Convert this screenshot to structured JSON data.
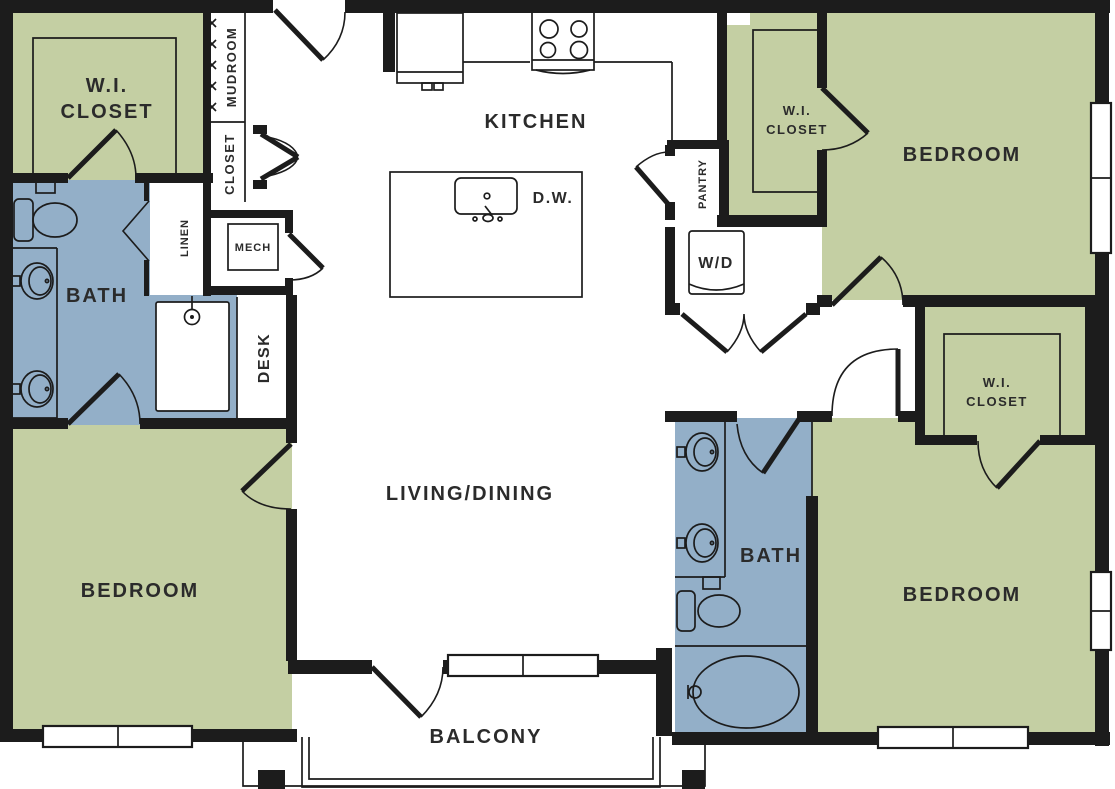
{
  "title": "Apartment floor plan",
  "colors": {
    "room_green": "#c4cfa3",
    "room_blue": "#93afc8",
    "wall": "#1c1c1c",
    "text": "#2b2b2b",
    "background": "#ffffff"
  },
  "rooms": [
    {
      "id": "wi-closet-top-left",
      "label_line1": "W.I.",
      "label_line2": "CLOSET"
    },
    {
      "id": "mudroom",
      "label": "MUDROOM"
    },
    {
      "id": "entry-closet",
      "label": "CLOSET"
    },
    {
      "id": "linen",
      "label": "LINEN"
    },
    {
      "id": "mech",
      "label": "MECH"
    },
    {
      "id": "bath-master",
      "label": "BATH"
    },
    {
      "id": "desk",
      "label": "DESK"
    },
    {
      "id": "kitchen",
      "label": "KITCHEN"
    },
    {
      "id": "dishwasher",
      "label": "D.W."
    },
    {
      "id": "pantry",
      "label": "PANTRY"
    },
    {
      "id": "washer-dryer",
      "label": "W/D"
    },
    {
      "id": "wi-closet-top-right",
      "label_line1": "W.I.",
      "label_line2": "CLOSET"
    },
    {
      "id": "bedroom-top-right",
      "label": "BEDROOM"
    },
    {
      "id": "wi-closet-mid-right",
      "label_line1": "W.I.",
      "label_line2": "CLOSET"
    },
    {
      "id": "living-dining",
      "label": "LIVING/DINING"
    },
    {
      "id": "bath-second",
      "label": "BATH"
    },
    {
      "id": "bedroom-bottom-left",
      "label": "BEDROOM"
    },
    {
      "id": "bedroom-bottom-right",
      "label": "BEDROOM"
    },
    {
      "id": "balcony",
      "label": "BALCONY"
    }
  ]
}
